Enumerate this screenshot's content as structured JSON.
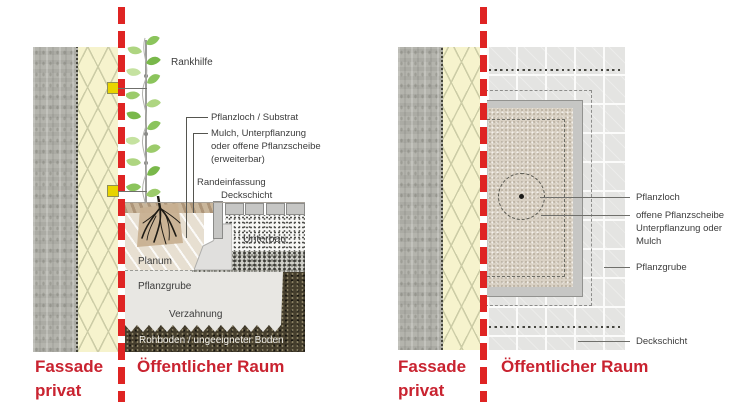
{
  "colors": {
    "boundary_line_red": "#df2423",
    "zone_text_red": "#c92330",
    "annotation_text": "#3c3c3c",
    "insulation_yellow": "#f6f3cd",
    "concrete_gray": "#b4b4ad",
    "tile_gray": "#e4e4e2",
    "planting_bed_beige": "#d9d1c4",
    "edge_frame_gray": "#c6c6c4",
    "subsoil_dark": "#453e2d"
  },
  "section_view": {
    "labels": {
      "rankhilfe": "Rankhilfe",
      "pflanzloch_substrat": "Pflanzloch / Substrat",
      "mulch_line1": "Mulch, Unterpflanzung",
      "mulch_line2": "oder offene Pflanzscheibe",
      "mulch_line3": "(erweiterbar)",
      "randeinfassung": "Randeinfassung",
      "deckschicht": "Deckschicht",
      "unterbau": "Unterbau",
      "planum": "Planum",
      "pflanzgrube": "Pflanzgrube",
      "verzahnung": "Verzahnung",
      "rohboden": "Rohboden / ungeeigneter Boden"
    },
    "zone_left_line1": "Fassade",
    "zone_left_line2": "privat",
    "zone_right": "Öffentlicher Raum"
  },
  "plan_view": {
    "labels": {
      "pflanzloch": "Pflanzloch",
      "scheibe_line1": "offene Pflanzscheibe",
      "scheibe_line2": "Unterpflanzung oder",
      "scheibe_line3": "Mulch",
      "pflanzgrube": "Pflanzgrube",
      "deckschicht": "Deckschicht"
    },
    "zone_left_line1": "Fassade",
    "zone_left_line2": "privat",
    "zone_right": "Öffentlicher Raum"
  }
}
